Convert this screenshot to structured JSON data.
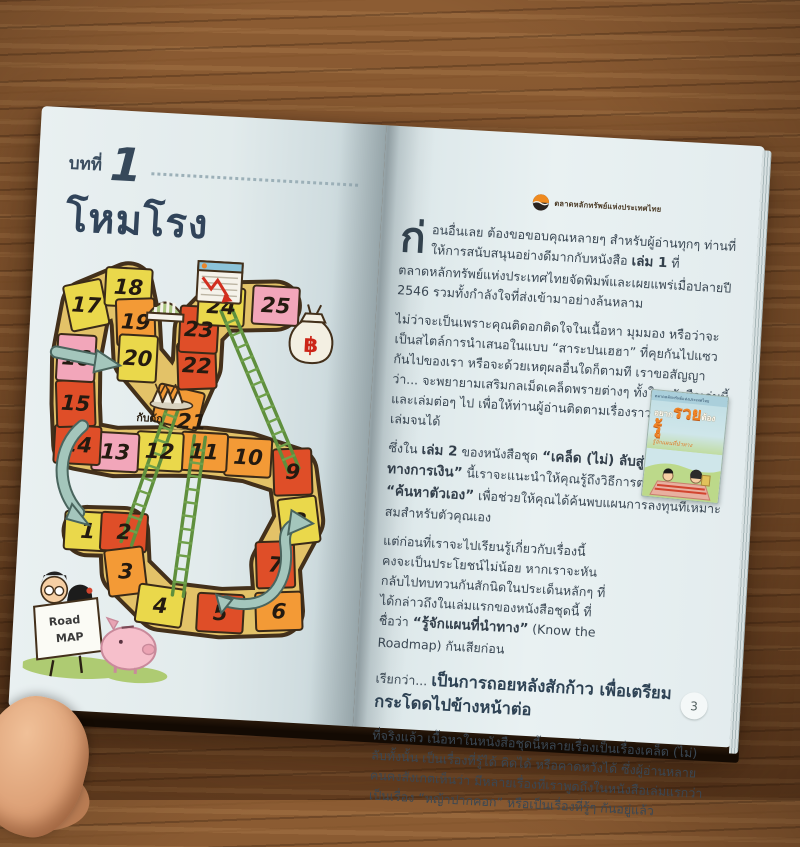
{
  "left_page": {
    "chapter_label": "บทที่",
    "chapter_number": "1",
    "chapter_title": "โหมโรง",
    "board": {
      "cells": [
        {
          "n": "1",
          "c": "yellow"
        },
        {
          "n": "2",
          "c": "red"
        },
        {
          "n": "3",
          "c": "orange"
        },
        {
          "n": "4",
          "c": "yellow"
        },
        {
          "n": "5",
          "c": "red"
        },
        {
          "n": "6",
          "c": "orange"
        },
        {
          "n": "7",
          "c": "red"
        },
        {
          "n": "8",
          "c": "yellow"
        },
        {
          "n": "9",
          "c": "red"
        },
        {
          "n": "10",
          "c": "orange"
        },
        {
          "n": "11",
          "c": "orange"
        },
        {
          "n": "12",
          "c": "yellow"
        },
        {
          "n": "13",
          "c": "pink"
        },
        {
          "n": "14",
          "c": "red"
        },
        {
          "n": "15",
          "c": "red"
        },
        {
          "n": "16",
          "c": "pink"
        },
        {
          "n": "17",
          "c": "yellow"
        },
        {
          "n": "18",
          "c": "yellow"
        },
        {
          "n": "19",
          "c": "orange"
        },
        {
          "n": "20",
          "c": "yellow"
        },
        {
          "n": "21",
          "c": "orange"
        },
        {
          "n": "22",
          "c": "red"
        },
        {
          "n": "23",
          "c": "red"
        },
        {
          "n": "24",
          "c": "yellow"
        },
        {
          "n": "25",
          "c": "pink"
        }
      ],
      "cell_colors": {
        "red": "#df4e28",
        "orange": "#f39a36",
        "yellow": "#ead84b",
        "pink": "#f2a6ba"
      },
      "trap_label": "กับดัก",
      "baht_symbol": "฿",
      "sign_line1": "Road",
      "sign_line2": "MAP"
    }
  },
  "right_page": {
    "logo_text": "ตลาดหลักทรัพย์แห่งประเทศไทย",
    "page_number": "3",
    "book_cover": {
      "title_part1": "อยาก",
      "title_part2": "รวย",
      "title_part3": "ต้อง",
      "title_part4": "รู้",
      "subtitle": "รู้จักแผนที่นำทาง"
    },
    "paragraphs": [
      {
        "dropcap": "ก่",
        "segments": [
          {
            "t": "อนอื่นเลย ต้องขอขอบคุณหลายๆ สำหรับผู้อ่านทุกๆ ท่านที่ให้การสนับสนุนอย่างดีมากกับหนังสือ ",
            "s": "n"
          },
          {
            "t": "เล่ม 1",
            "s": "b"
          },
          {
            "t": " ที่ตลาดหลักทรัพย์แห่งประเทศไทยจัดพิมพ์และเผยแพร่เมื่อปลายปี 2546 รวมทั้งกำลังใจที่ส่งเข้ามาอย่างล้นหลาม",
            "s": "n"
          }
        ]
      },
      {
        "segments": [
          {
            "t": "ไม่ว่าจะเป็นเพราะคุณติดอกติดใจในเนื้อหา มุมมอง หรือว่าจะเป็นสไตล์การนำเสนอในแบบ “สาระปนเฮฮา” ที่คุยกันไปแซวกันไปของเรา หรือจะด้วยเหตุผลอื่นใดก็ตามที เราขอสัญญาว่า... จะพยายามเสริมกลเม็ดเคล็ดพรายต่างๆ ทั้งในหนังสือเล่มนี้และเล่มต่อๆ ไป เพื่อให้ท่านผู้อ่านติดตามเรื่องราวจนจบชุดทั้ง 4 เล่มจนได้",
            "s": "n"
          }
        ]
      },
      {
        "segments": [
          {
            "t": "ซึ่งใน ",
            "s": "n"
          },
          {
            "t": "เล่ม 2",
            "s": "b"
          },
          {
            "t": " ของหนังสือชุด ",
            "s": "n"
          },
          {
            "t": "“เคล็ด (ไม่) ลับสู่... อิสรภาพทางการเงิน”",
            "s": "b"
          },
          {
            "t": " นี้เราจะแนะนำให้คุณรู้ถึงวิธีการต่างๆในการ ",
            "s": "n"
          },
          {
            "t": "“ค้นหาตัวเอง”",
            "s": "b"
          },
          {
            "t": " เพื่อช่วยให้คุณได้ค้นพบแผนการลงทุนที่เหมาะสมสำหรับตัวคุณเอง",
            "s": "n"
          }
        ]
      },
      {
        "kind": "narrow",
        "segments": [
          {
            "t": "แต่ก่อนที่เราจะไปเรียนรู้เกี่ยวกับเรื่องนี้ คงจะเป็นประโยชน์ไม่น้อย หากเราจะหันกลับไปทบทวนกันสักนิดในประเด็นหลักๆ ที่ได้กล่าวถึงในเล่มแรกของหนังสือชุดนี้ ที่ชื่อว่า ",
            "s": "n"
          },
          {
            "t": "“รู้จักแผนที่นำทาง”",
            "s": "b"
          },
          {
            "t": " (Know the Roadmap) กันเสียก่อน",
            "s": "n"
          }
        ]
      },
      {
        "kind": "headline",
        "segments": [
          {
            "t": "เรียกว่า... ",
            "s": "lead"
          },
          {
            "t": "เป็นการถอยหลังสักก้าว เพื่อเตรียมกระโดดไปข้างหน้าต่อ",
            "s": "big"
          }
        ]
      },
      {
        "segments": [
          {
            "t": "ที่จริงแล้ว เนื้อหาในหนังสือชุดนี้หลายเรื่องเป็นเรื่องเคล็ด (ไม่) ลับทั้งนั้น เป็นเรื่องที่รู้ได้ คิดได้ หรือคาดหวังได้ ซึ่งผู้อ่านหลายคนคงสังเกตเห็นว่า มีหลายเรื่องที่เราพูดถึงในหนังสือเล่มแรกว่าเป็นเรื่อง “หญ้าปากคอก” หรือเป็นเรื่องที่รู้ๆ กันอยู่แล้ว",
            "s": "n"
          }
        ]
      }
    ]
  },
  "colors": {
    "wood": "#7e512b",
    "page": "#e6eef0",
    "title_blue": "#31445a",
    "arrow_teal": "#a4c6bc",
    "ladder_green": "#5f8f3d",
    "chart_red": "#d22f1f",
    "baht_red": "#cc2417"
  }
}
